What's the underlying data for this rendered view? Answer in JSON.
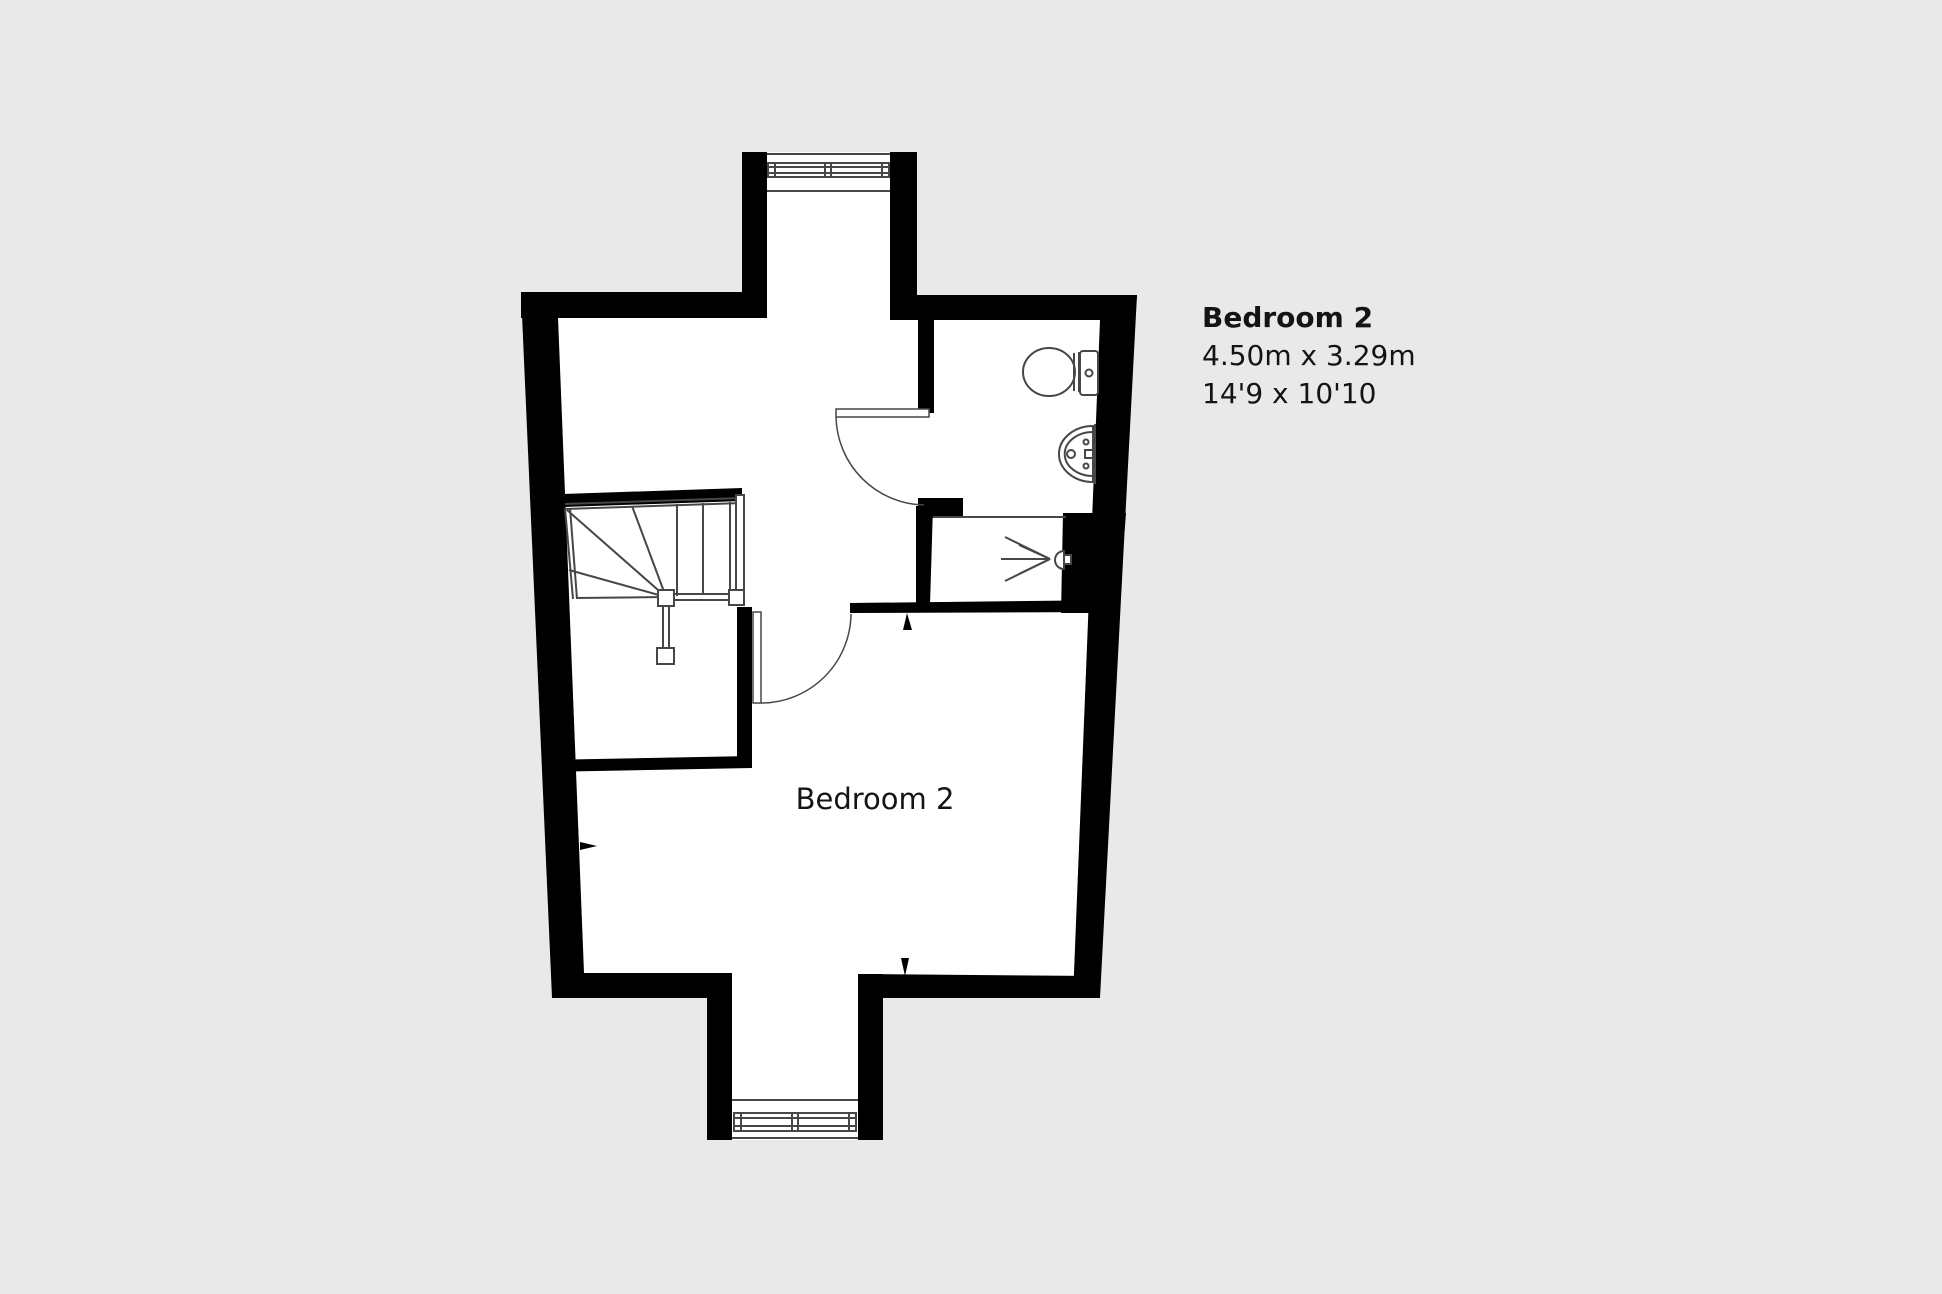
{
  "colors": {
    "background": "#e9e9e9",
    "wall": "#000000",
    "floor": "#ffffff",
    "line": "#474747",
    "text": "#141414"
  },
  "floor_plan": {
    "room_label": "Bedroom 2"
  },
  "annotation": {
    "title": "Bedroom 2",
    "size_metric": "4.50m x 3.29m",
    "size_imperial": "14'9 x 10'10"
  }
}
